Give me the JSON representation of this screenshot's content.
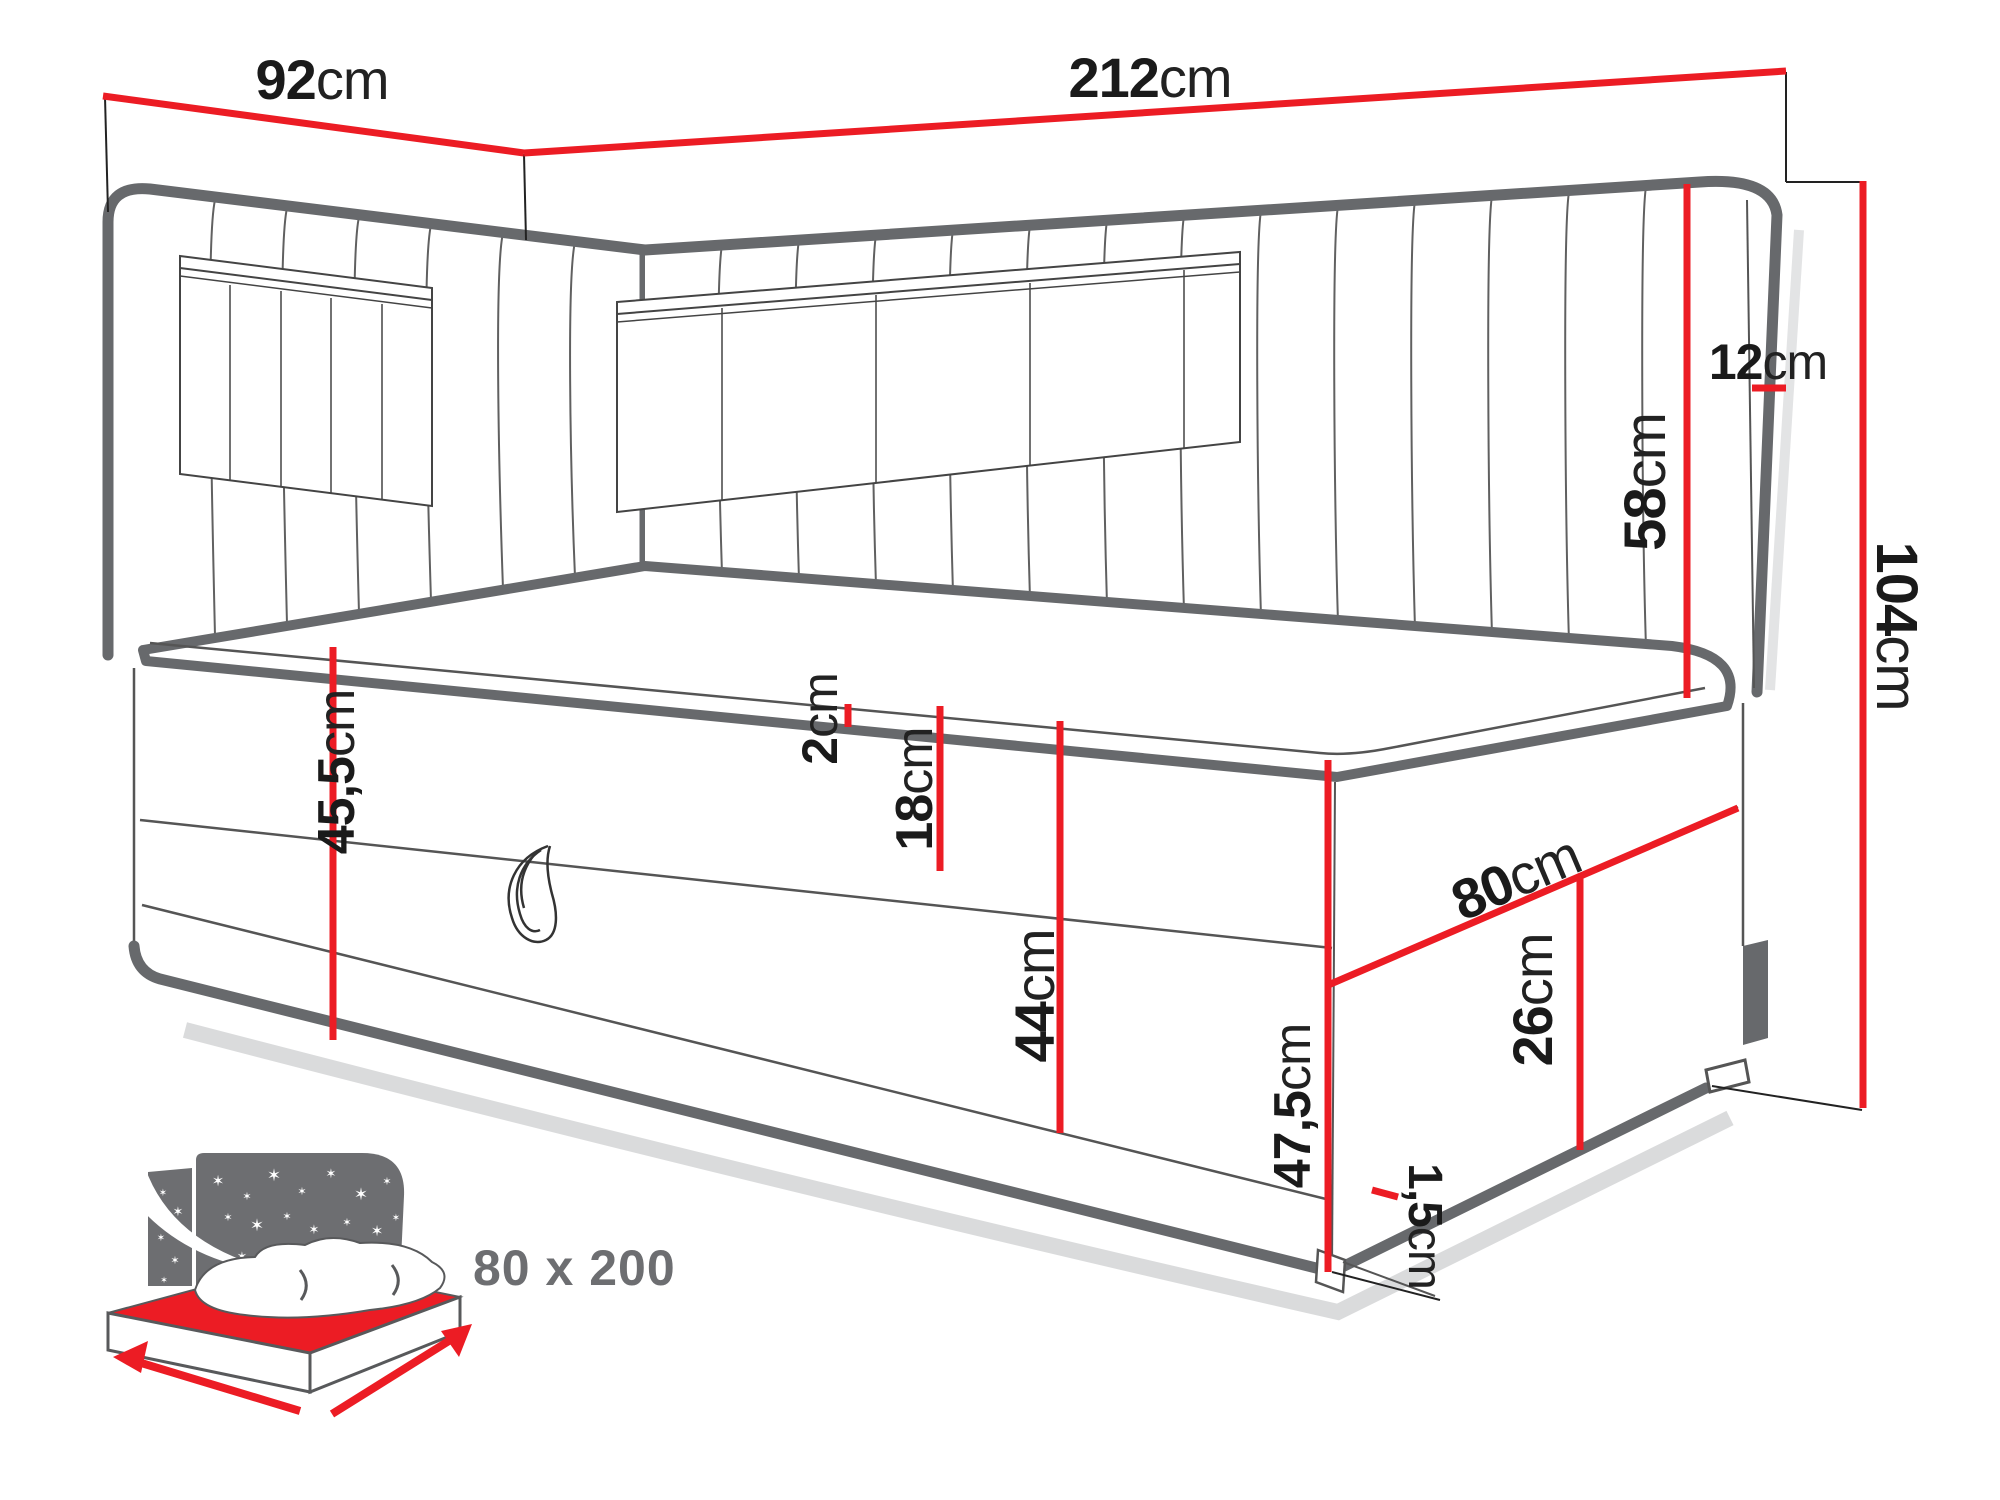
{
  "dims": [
    {
      "name": "side-width",
      "value": "92",
      "unit": "cm"
    },
    {
      "name": "total-length",
      "value": "212",
      "unit": "cm"
    },
    {
      "name": "headboard-height",
      "value": "58",
      "unit": "cm"
    },
    {
      "name": "headboard-thickness",
      "value": "12",
      "unit": "cm"
    },
    {
      "name": "total-height",
      "value": "104",
      "unit": "cm"
    },
    {
      "name": "base-height-left",
      "value": "45,5",
      "unit": "cm"
    },
    {
      "name": "topper-thickness",
      "value": "2",
      "unit": "cm"
    },
    {
      "name": "mattress-depth",
      "value": "18",
      "unit": "cm"
    },
    {
      "name": "storage-height",
      "value": "44",
      "unit": "cm"
    },
    {
      "name": "base-height-front",
      "value": "47,5",
      "unit": "cm"
    },
    {
      "name": "bed-width",
      "value": "80",
      "unit": "cm"
    },
    {
      "name": "flap-height",
      "value": "26",
      "unit": "cm"
    },
    {
      "name": "plinth-clearance",
      "value": "1,5",
      "unit": "cm"
    }
  ],
  "icon": {
    "footprint_label": "80 x 200",
    "meaning": "sleeping-area-size-icon"
  },
  "colors": {
    "dimension_red": "#ec1c24",
    "outline_gray": "#67696c",
    "icon_gray": "#6d6e71",
    "label_black": "#1a1a1a"
  }
}
